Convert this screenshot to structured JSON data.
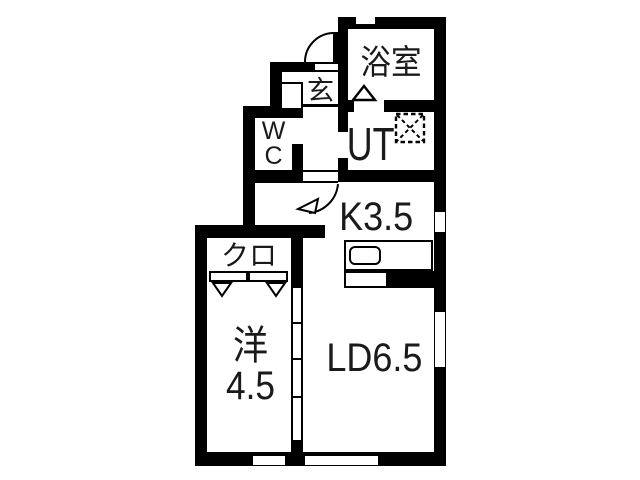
{
  "floorplan": {
    "rooms": {
      "bathroom": "浴室",
      "entrance": "玄",
      "toilet": "W\nC",
      "utility": "UT",
      "kitchen": "K3.5",
      "closet": "クロ",
      "western_room": "洋4.5",
      "living_dining": "LD6.5"
    },
    "colors": {
      "wall": "#000000",
      "floor": "#ffffff",
      "text": "#1a1a1a"
    }
  }
}
